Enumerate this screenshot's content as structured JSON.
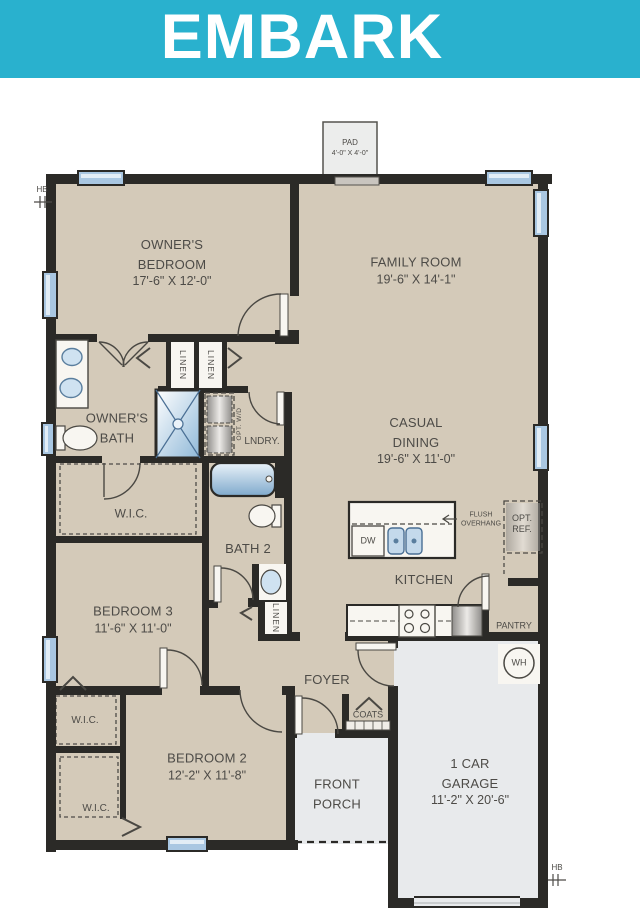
{
  "title": "EMBARK",
  "rooms": {
    "owners_bedroom": {
      "name": "OWNER'S BEDROOM",
      "dims": "17'-6\" X 12'-0\""
    },
    "family_room": {
      "name": "FAMILY ROOM",
      "dims": "19'-6\" X 14'-1\""
    },
    "owners_bath": {
      "name": "OWNER'S BATH"
    },
    "casual_dining": {
      "name": "CASUAL DINING",
      "dims": "19'-6\" X 11'-0\""
    },
    "wic_owners": {
      "name": "W.I.C."
    },
    "bath2": {
      "name": "BATH 2"
    },
    "bedroom3": {
      "name": "BEDROOM 3",
      "dims": "11'-6\" X 11'-0\""
    },
    "kitchen": {
      "name": "KITCHEN"
    },
    "pantry": {
      "name": "PANTRY"
    },
    "lndry": {
      "name": "LNDRY."
    },
    "foyer": {
      "name": "FOYER"
    },
    "coats": {
      "name": "COATS"
    },
    "wic_bedroom3": {
      "name": "W.I.C."
    },
    "wic_bedroom2": {
      "name": "W.I.C."
    },
    "bedroom2": {
      "name": "BEDROOM 2",
      "dims": "12'-2\" X 11'-8\""
    },
    "front_porch": {
      "name": "FRONT PORCH"
    },
    "garage": {
      "name": "1 CAR GARAGE",
      "dims": "11'-2\" X 20'-6\""
    }
  },
  "features": {
    "linen": "LINEN",
    "opt_wd": "OPT. W/D",
    "dw": "DW",
    "opt_ref": {
      "line1": "OPT.",
      "line2": "REF."
    },
    "flush_overhang": {
      "line1": "FLUSH",
      "line2": "OVERHANG"
    },
    "water_heater": "WH",
    "pad": {
      "name": "PAD",
      "dims": "4'-0\" X 4'-0\""
    },
    "hose_bib": "HB"
  },
  "colors": {
    "banner": "#29b1ce",
    "floor_tan": "#d4cab9",
    "floor_gray": "#e8eaec",
    "wall": "#2b2a27",
    "window": "#a9c7e2",
    "fixture_blue": "#cfe2f1",
    "text": "#4d4b47"
  }
}
